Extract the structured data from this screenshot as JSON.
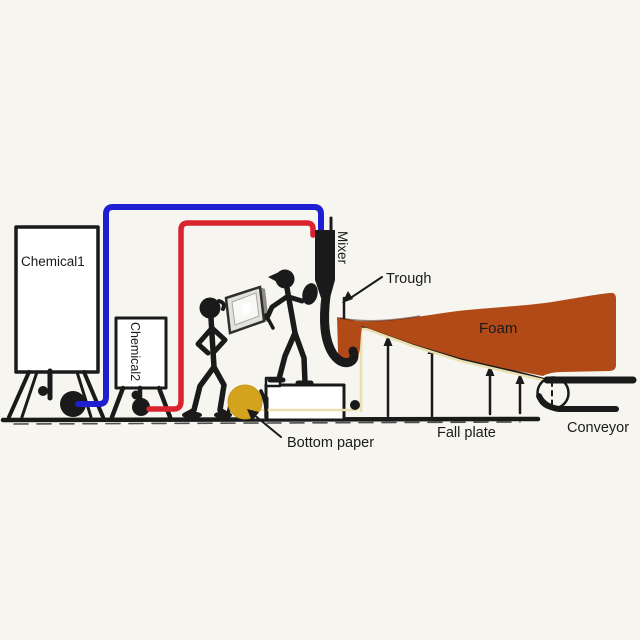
{
  "diagram": {
    "title_hint": "foam production line schematic",
    "labels": {
      "chemical1": "Chemical1",
      "chemical2": "Chemical2",
      "mixer": "Mixer",
      "trough": "Trough",
      "foam": "Foam",
      "bottom_paper": "Bottom paper",
      "fall_plate": "Fall plate",
      "conveyor": "Conveyor"
    },
    "colors": {
      "ink": "#1a1a1a",
      "pipe_blue": "#1d1fd0",
      "pipe_red": "#d92430",
      "foam": "#b14a17",
      "paper_roll": "#d4a31e",
      "paper_line": "#eadfb0",
      "tank_fill": "#ffffff",
      "panel_face": "#e4e2dd",
      "panel_screen": "#f7f7f5",
      "background": "#f7f5f0"
    }
  }
}
